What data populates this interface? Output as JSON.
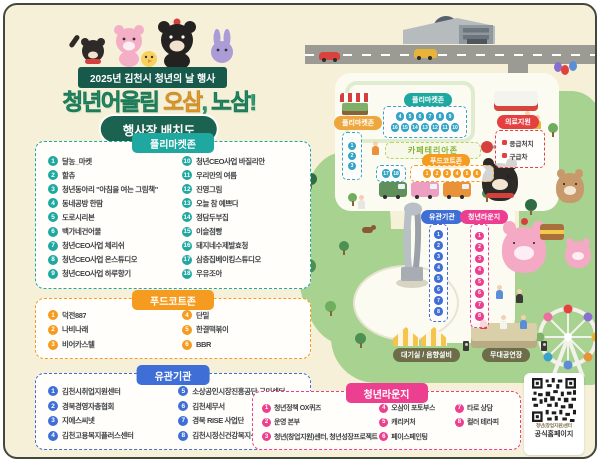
{
  "header": {
    "event_banner": "2025년 김천시 청년의 날 행사",
    "title": {
      "part1": "청년어울림 ",
      "part2": "오삼",
      "part3": ", 노삼!"
    },
    "subtitle_badge": "행사장 배치도"
  },
  "legend_panels": {
    "flea_market": {
      "title": "플리마켓존",
      "items": [
        "달농_마켓",
        "할츄",
        "청년동아리 \"아침을 여는 그림책\"",
        "동네공방 한땀",
        "도로시리본",
        "백가네건어물",
        "청년CEO사업 체리쉬",
        "청년CEO사업 온스튜디오",
        "청년CEO사업 하루향기",
        "청년CEO사업 바질리안",
        "우리만의 여름",
        "진영그림",
        "오늘 참 예쁘다",
        "정담두부집",
        "이슬점빵",
        "돼지네수제발효청",
        "삼층집베이킹스튜디오",
        "우유조아"
      ]
    },
    "food_court": {
      "title": "푸드코트존",
      "items": [
        "덕전887",
        "나비나래",
        "비어카스텔",
        "단밀",
        "한결떡볶이",
        "BBR"
      ]
    },
    "organizations": {
      "title": "유관기관",
      "items": [
        "김천시취업지원센터",
        "경북경영자총협회",
        "지에스씨넷",
        "김천고용복지플러스센터",
        "소상공인시장진흥공단 구미센터",
        "김천세무서",
        "경북 RISE 사업단",
        "김천시정신건강복지센터"
      ]
    },
    "youth_lounge": {
      "title": "청년라운지",
      "items": [
        "청년정책 OX퀴즈",
        "운영 본부",
        "청년(창업지원)센터, 청년성장프로젝트",
        "오삼이 포토부스",
        "캐리커처",
        "페이스페인팅",
        "타로 상담",
        "컬러 테라피"
      ]
    }
  },
  "map": {
    "zones": {
      "flea_small_label": "플리마켓존",
      "flea_main_label": "플리마켓존",
      "cafeteria_label": "카페테리아존",
      "medical_label": "의료지원",
      "medical_items": [
        "응급처치",
        "구급차"
      ],
      "food_court_label": "푸드코트존",
      "organizations_label": "유관기관",
      "youth_lounge_label": "청년라운지",
      "waiting_room_label": "대기실 / 음향설비",
      "stage_label": "무대공연장"
    },
    "markers": {
      "flea_left": [
        "1",
        "2",
        "3"
      ],
      "flea_top": [
        "4",
        "5",
        "6",
        "7",
        "8",
        "9"
      ],
      "flea_bottom": [
        "16",
        "15",
        "14",
        "13",
        "12",
        "11",
        "10"
      ],
      "flea_side": [
        "17",
        "18"
      ],
      "food_court": [
        "1",
        "2",
        "3",
        "4",
        "5",
        "6"
      ],
      "organizations": [
        "1",
        "2",
        "3",
        "4",
        "5",
        "6",
        "7",
        "8"
      ],
      "youth_lounge": [
        "1",
        "2",
        "3",
        "4",
        "5",
        "6",
        "7",
        "8"
      ]
    }
  },
  "qr": {
    "caption_line1": "청년(창업지원)센터",
    "caption_line2": "공식홈페이지"
  },
  "colors": {
    "background": "#f7f0d9",
    "frame": "#43483f",
    "teal": "#1fa8a0",
    "orange": "#f59b1f",
    "blue": "#3f6fd6",
    "pink": "#ec3f90",
    "red": "#e4403f",
    "dark_green": "#175a4b",
    "map_marker_blue": "#33a3c6",
    "grass": "#a8d290",
    "title_green": "#2f9c74",
    "title_gold": "#f0ae2c"
  }
}
